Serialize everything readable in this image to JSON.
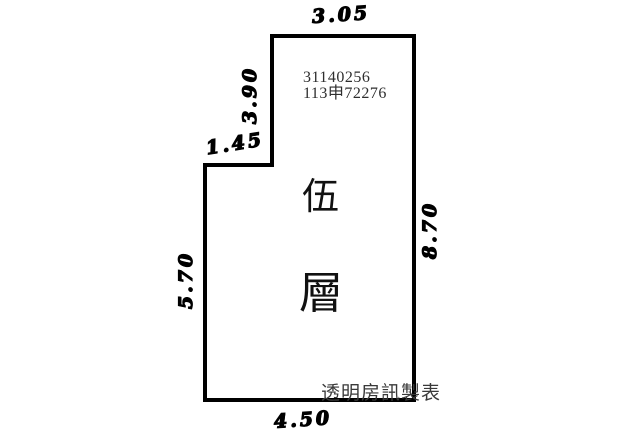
{
  "diagram": {
    "type": "floor-plan-survey-sketch",
    "floor_label": {
      "char1": "伍",
      "char2": "層",
      "meaning": "fifth floor"
    },
    "printed_ids": {
      "line1": "31140256",
      "line2": "113申72276"
    },
    "watermark": "透明房訊製表",
    "dimensions": {
      "top": "3.05",
      "upper_left": "3.90",
      "step": "1.45",
      "lower_left": "5.70",
      "right": "8.70",
      "bottom": "4.50"
    },
    "colors": {
      "line": "#000000",
      "printed_text": "#2e2e2e",
      "background": "#ffffff"
    }
  }
}
